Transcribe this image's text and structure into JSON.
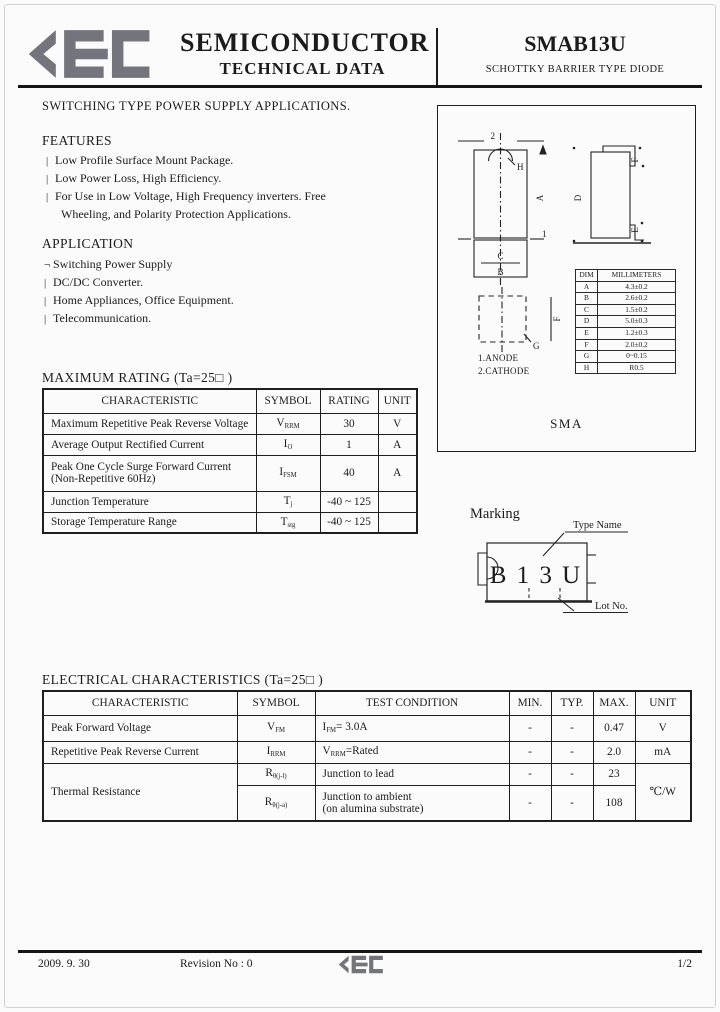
{
  "page": {
    "bg": "#fbfbfb",
    "ink": "#1b1b1b",
    "brand_gray": "#74747c"
  },
  "header": {
    "brand": "KEC",
    "title_line1": "SEMICONDUCTOR",
    "title_line2": "TECHNICAL DATA",
    "part_number": "SMAB13U",
    "part_type": "SCHOTTKY BARRIER TYPE DIODE"
  },
  "intro": "SWITCHING TYPE POWER SUPPLY APPLICATIONS.",
  "features": {
    "title": "FEATURES",
    "items": [
      {
        "bullet": "|",
        "text": "Low Profile Surface Mount Package."
      },
      {
        "bullet": "|",
        "text": "Low Power Loss, High Efficiency."
      },
      {
        "bullet": "|",
        "text": "For Use in Low Voltage, High Frequency inverters. Free"
      },
      {
        "bullet": "",
        "text": "Wheeling, and Polarity Protection Applications."
      }
    ]
  },
  "application": {
    "title": "APPLICATION",
    "items": [
      {
        "bullet": "¬",
        "text": "Switching Power Supply"
      },
      {
        "bullet": "|",
        "text": "DC/DC Converter."
      },
      {
        "bullet": "|",
        "text": "Home Appliances, Office Equipment."
      },
      {
        "bullet": "|",
        "text": "Telecommunication."
      }
    ]
  },
  "max_rating": {
    "title": "MAXIMUM RATING  (Ta=25□ )",
    "headers": {
      "characteristic": "CHARACTERISTIC",
      "symbol": "SYMBOL",
      "rating": "RATING",
      "unit": "UNIT"
    },
    "rows": [
      {
        "characteristic": "Maximum Repetitive Peak Reverse Voltage",
        "sym": "V",
        "sub": "RRM",
        "rating": "30",
        "unit": "V"
      },
      {
        "characteristic": "Average Output Rectified Current",
        "sym": "I",
        "sub": "O",
        "rating": "1",
        "unit": "A"
      },
      {
        "characteristic": "Peak One Cycle Surge Forward Current\n(Non-Repetitive 60Hz)",
        "sym": "I",
        "sub": "FSM",
        "rating": "40",
        "unit": "A"
      },
      {
        "characteristic": "Junction Temperature",
        "sym": "T",
        "sub": "j",
        "rating": "-40 ~ 125",
        "unit": ""
      },
      {
        "characteristic": "Storage Temperature Range",
        "sym": "T",
        "sub": "stg",
        "rating": "-40 ~ 125",
        "unit": ""
      }
    ]
  },
  "package": {
    "name": "SMA",
    "anode_note": "1.ANODE",
    "cathode_note": "2.CATHODE",
    "labels": {
      "pin1": "1",
      "pin2": "2",
      "a": "A",
      "b": "B",
      "c": "C",
      "d": "D",
      "e": "E",
      "f": "F",
      "g": "G",
      "h": "H"
    },
    "dim_table": {
      "col_dim": "DIM",
      "col_mm": "MILLIMETERS",
      "rows": [
        {
          "dim": "A",
          "mm": "4.3±0.2"
        },
        {
          "dim": "B",
          "mm": "2.6±0.2"
        },
        {
          "dim": "C",
          "mm": "1.5±0.2"
        },
        {
          "dim": "D",
          "mm": "5.0±0.3"
        },
        {
          "dim": "E",
          "mm": "1.2±0.3"
        },
        {
          "dim": "F",
          "mm": "2.0±0.2"
        },
        {
          "dim": "G",
          "mm": "0~0.15"
        },
        {
          "dim": "H",
          "mm": "R0.5"
        }
      ]
    }
  },
  "marking": {
    "title": "Marking",
    "code": "B 1 3 U",
    "type_name_label": "Type Name",
    "lot_no_label": "Lot No."
  },
  "elec": {
    "title": "ELECTRICAL CHARACTERISTICS  (Ta=25□ )",
    "headers": {
      "characteristic": "CHARACTERISTIC",
      "symbol": "SYMBOL",
      "test_condition": "TEST CONDITION",
      "min": "MIN.",
      "typ": "TYP.",
      "max": "MAX.",
      "unit": "UNIT"
    },
    "rows": {
      "peak_forward_voltage": {
        "characteristic": "Peak Forward Voltage",
        "sym": "V",
        "sub": "FM",
        "cond_sym": "I",
        "cond_sub": "FM",
        "cond_rest": "= 3.0A",
        "min": "-",
        "typ": "-",
        "max": "0.47",
        "unit": "V"
      },
      "reverse_current": {
        "characteristic": "Repetitive Peak Reverse Current",
        "sym": "I",
        "sub": "RRM",
        "cond_sym": "V",
        "cond_sub": "RRM",
        "cond_rest": "=Rated",
        "min": "-",
        "typ": "-",
        "max": "2.0",
        "unit": "mA"
      },
      "thermal": {
        "characteristic": "Thermal Resistance",
        "unit": "℃/W",
        "jl": {
          "sym": "R",
          "sub": "θ(j-l)",
          "cond": "Junction to lead",
          "min": "-",
          "typ": "-",
          "max": "23"
        },
        "ja": {
          "sym": "R",
          "sub": "θ(j-a)",
          "cond": "Junction to ambient\n(on alumina substrate)",
          "min": "-",
          "typ": "-",
          "max": "108"
        }
      }
    }
  },
  "footer": {
    "date": "2009. 9. 30",
    "revision": "Revision No : 0",
    "brand": "KEC",
    "page": "1/2"
  }
}
